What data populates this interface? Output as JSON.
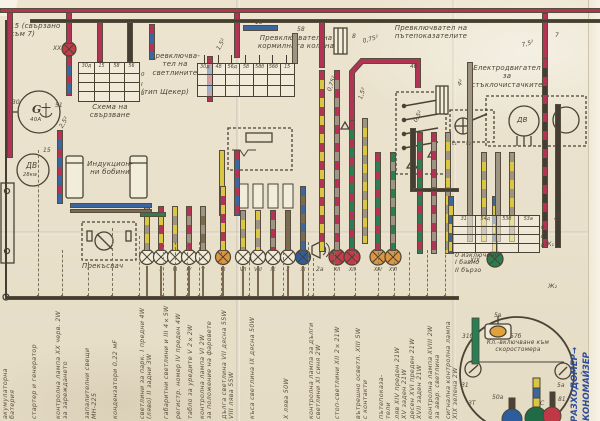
{
  "palette": {
    "paper": "#e9e1cc",
    "ink": "#4a4335",
    "red": "#b23353",
    "blue": "#3b66a0",
    "yellow": "#d9c642",
    "green": "#2e7d52",
    "gray": "#9d9484",
    "brown": "#7b6a52",
    "orange": "#dd9540",
    "hand_ink": "#2b4d9c"
  },
  "top": {
    "corner_label": "15 (свързано\nкъм 7)"
  },
  "light_switch": {
    "title": "Превключва-\nтел на\nсветлините",
    "type_note": "(тип Щекер)",
    "caption": "Схема на\nсвързване",
    "headers": [
      "30д",
      "15",
      "58",
      "56"
    ],
    "positions": [
      "0",
      "I",
      "II"
    ]
  },
  "steering": {
    "title": "Превключвател на\nкормилната колона",
    "pins": [
      "30д",
      "4б",
      "56д",
      "58",
      "58б",
      "56б",
      "15"
    ]
  },
  "turn": {
    "title": "Превключвател на\nпътепоказателите"
  },
  "wiper": {
    "title": "Електродвигател\nза\nстъклочистачките",
    "motor": "ДВ",
    "headers": [
      "31",
      "54д",
      "53б",
      "53а"
    ],
    "positions": [
      "0",
      "I",
      "II"
    ],
    "modes": "0  изключено\nI  бавно\nII  бързо"
  },
  "generator": {
    "symbol": "G",
    "rating": "40А"
  },
  "starter": {
    "symbol": "ДВ",
    "rating": "28кw"
  },
  "coils": {
    "label": "Индукцион-\nни бобини"
  },
  "breaker": {
    "label": "Прекъсвач"
  },
  "speedo": {
    "note": "Кл.-включване към\nскоростомера"
  },
  "handwriting": [
    "РАЗХОДОМЕР→",
    "ИКОНОМАЙЗЕР"
  ],
  "lamps": {
    "main": [
      "I",
      "II",
      "III",
      "IV",
      "V",
      "VI",
      "VII",
      "VIII",
      "IX",
      "X",
      "XI"
    ],
    "stop": [
      "XII",
      "XII"
    ],
    "turn": [
      "XIV",
      "XVI"
    ],
    "charge": "XX",
    "signal": "XIX"
  },
  "annotations": [
    {
      "t": "XX",
      "x": 53,
      "y": 45
    },
    {
      "t": "30",
      "x": 12,
      "y": 99
    },
    {
      "t": "51",
      "x": 55,
      "y": 102
    },
    {
      "t": "15",
      "x": 43,
      "y": 147
    },
    {
      "t": "2,5²",
      "x": 58,
      "y": 126,
      "r": -60
    },
    {
      "t": "1,5²",
      "x": 215,
      "y": 48,
      "r": -60
    },
    {
      "t": "15",
      "x": 255,
      "y": 19
    },
    {
      "t": "58",
      "x": 297,
      "y": 26
    },
    {
      "t": "0,75²",
      "x": 362,
      "y": 38,
      "r": -15
    },
    {
      "t": "8",
      "x": 352,
      "y": 33
    },
    {
      "t": "4б",
      "x": 410,
      "y": 63
    },
    {
      "t": "7",
      "x": 555,
      "y": 32
    },
    {
      "t": "7,5²",
      "x": 521,
      "y": 42,
      "r": -15
    },
    {
      "t": "4²",
      "x": 456,
      "y": 84,
      "r": -60
    },
    {
      "t": "0,5²",
      "x": 412,
      "y": 120,
      "r": -60
    },
    {
      "t": "t₁",
      "x": 452,
      "y": 140
    },
    {
      "t": "t₂",
      "x": 466,
      "y": 140
    },
    {
      "t": "0,75²",
      "x": 326,
      "y": 90,
      "r": -70
    },
    {
      "t": "1,5²",
      "x": 357,
      "y": 98,
      "r": -70
    },
    {
      "t": "15²",
      "x": 553,
      "y": 220,
      "r": -70
    },
    {
      "t": "Ж₁",
      "x": 545,
      "y": 241
    },
    {
      "t": "Ж₂",
      "x": 548,
      "y": 283
    },
    {
      "t": "XIX",
      "x": 470,
      "y": 257
    },
    {
      "t": "2а",
      "x": 316,
      "y": 266
    },
    {
      "t": "5в",
      "x": 494,
      "y": 312
    },
    {
      "t": "31б",
      "x": 462,
      "y": 333
    },
    {
      "t": "57б",
      "x": 510,
      "y": 333
    },
    {
      "t": "З1",
      "x": 461,
      "y": 382
    },
    {
      "t": "5а",
      "x": 557,
      "y": 382
    },
    {
      "t": "50а",
      "x": 492,
      "y": 394
    },
    {
      "t": "С",
      "x": 540,
      "y": 400
    },
    {
      "t": "81",
      "x": 558,
      "y": 396
    },
    {
      "t": "ЗТ",
      "x": 468,
      "y": 400
    }
  ],
  "bottom_labels": [
    {
      "x": 2,
      "lines": "акумулаторна\nбатерия"
    },
    {
      "x": 31,
      "lines": "стартер и генератор"
    },
    {
      "x": 55,
      "lines": "контролна лампа XX черв. 2W\nза зареждането"
    },
    {
      "x": 84,
      "lines": "запалителни свещи\nМН-225"
    },
    {
      "x": 112,
      "lines": "кондензатори  0,22 мF"
    },
    {
      "x": 139,
      "lines": "светлини за парк. I предни 4W\n(ляво)  II задни 3W"
    },
    {
      "x": 163,
      "lines": "габаритни светлини и  III  4×5W"
    },
    {
      "x": 175,
      "lines": "регистр. номер  IV преден 4W"
    },
    {
      "x": 187,
      "lines": "табло за уредите  V  2×2W"
    },
    {
      "x": 199,
      "lines": "контролна лампа  VI  2W\nза положение на фаровете"
    },
    {
      "x": 221,
      "lines": "дълга светлина VII дясна 55W\nVIII лява  55W"
    },
    {
      "x": 249,
      "lines": "къса светлина  IX дясна 50W"
    },
    {
      "x": 283,
      "lines": "X лява  50W"
    },
    {
      "x": 308,
      "lines": "контролна лампа за дълги\nсветлини  XI синя 2W"
    },
    {
      "x": 334,
      "lines": "стоп-светлини  XII  2×21W"
    },
    {
      "x": 355,
      "lines": "вътрешно осветл. XIII 5W\nс контакти"
    },
    {
      "x": 378,
      "lines": "пътепоказа-\nтели"
    },
    {
      "x": 394,
      "lines": "ляв  XIV преден 21W\nXV заден  21W"
    },
    {
      "x": 409,
      "lines": "десен  XVI преден 21W\nXVII заден  21W"
    },
    {
      "x": 427,
      "lines": "контролна лампа  XVIII 2W\nза авар. светлина"
    },
    {
      "x": 445,
      "lines": "сигнална контролна лампа\nXIX зелена  2W"
    }
  ]
}
